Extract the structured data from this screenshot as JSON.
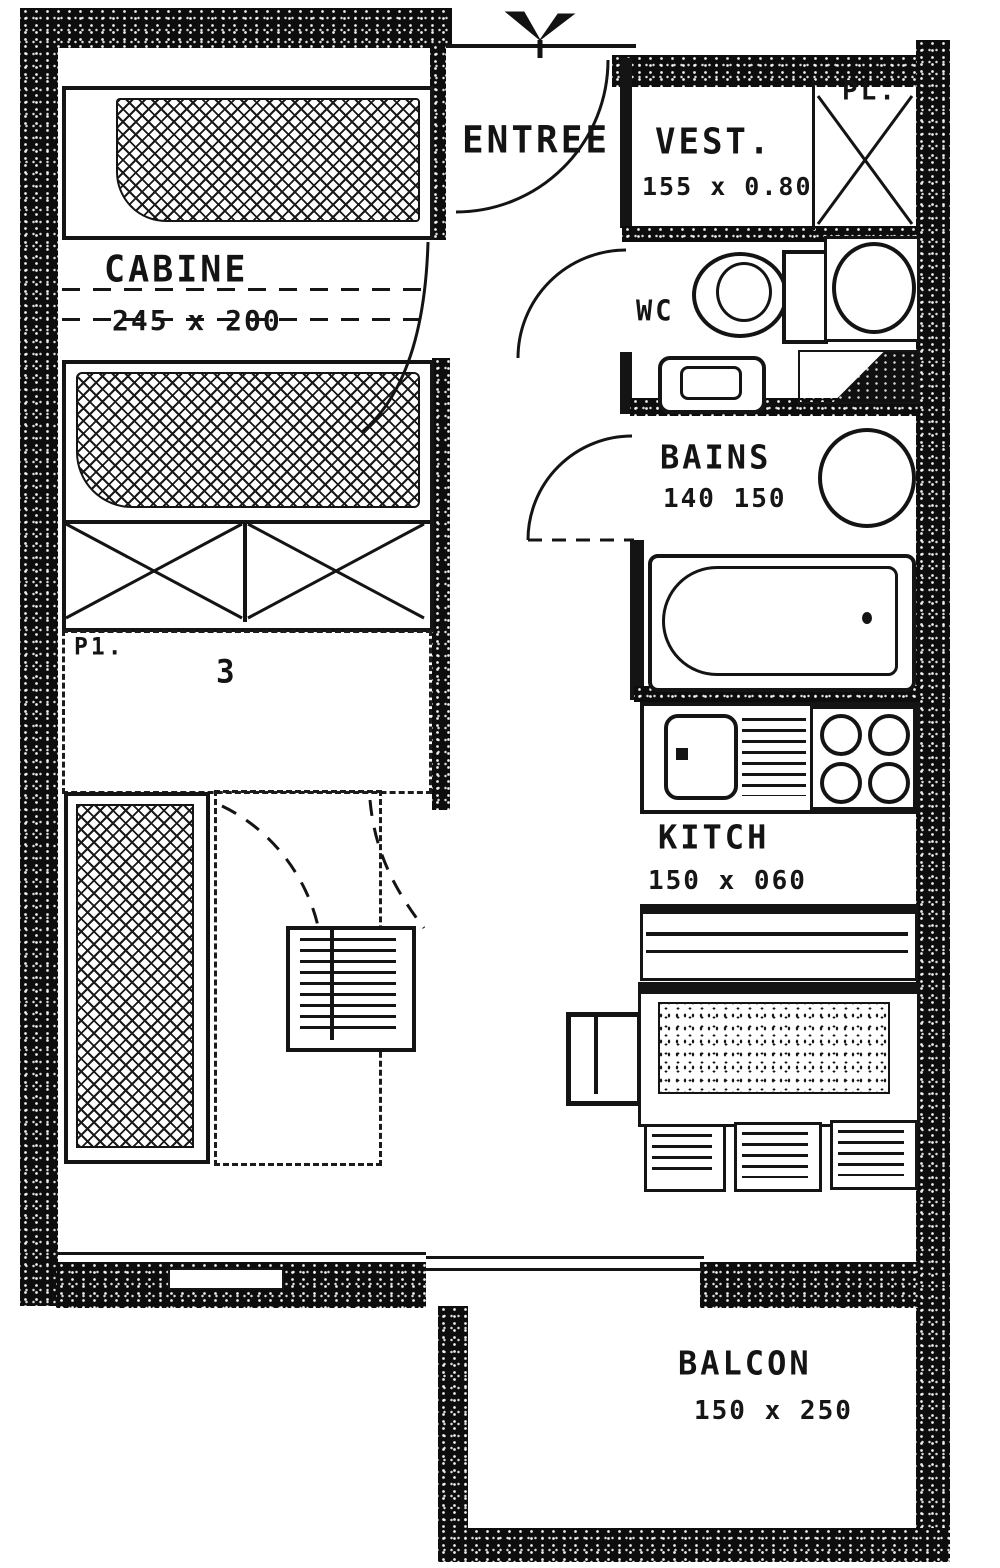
{
  "document": {
    "type": "scanned apartment floor plan"
  },
  "colors": {
    "ink": "#121212",
    "paper": "#ffffff"
  },
  "rooms": {
    "entree": {
      "label": "ENTREE"
    },
    "vest": {
      "label": "VEST.",
      "dims": "155 x 0.80"
    },
    "pl": {
      "label": "PL."
    },
    "wc": {
      "label": "WC"
    },
    "cabine": {
      "label": "CABINE",
      "dims": "245 x 200"
    },
    "bains": {
      "label": "BAINS",
      "dims": "140 150"
    },
    "kitch": {
      "label": "KITCH",
      "dims": "150 x 060"
    },
    "balcon": {
      "label": "BALCON",
      "dims": "150 x 250"
    }
  },
  "annotations": {
    "p1": "P1.",
    "zone_number": "3"
  }
}
